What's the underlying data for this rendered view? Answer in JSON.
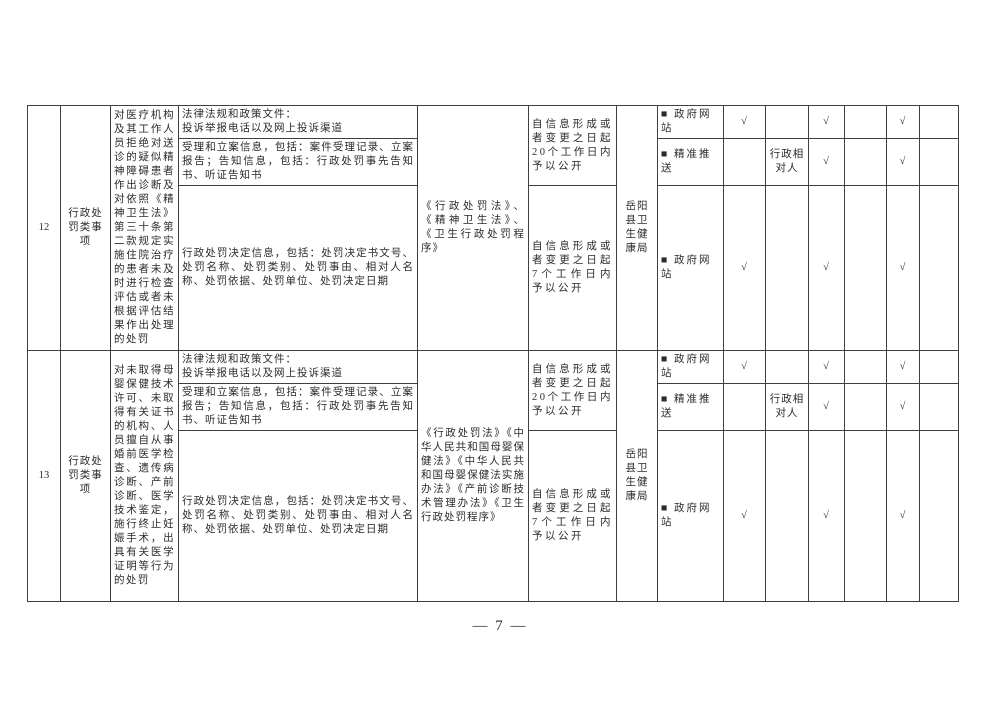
{
  "page": {
    "footer": "— 7 —"
  },
  "table": {
    "rows": [
      {
        "id": "12",
        "category": "行政处罚类事项",
        "description": "对医疗机构及其工作人员拒绝对送诊的疑似精神障碍患者作出诊断及对依照《精神卫生法》第三十条第二款规定实施住院治疗的患者未及时进行检查评估或者未根据评估结果作出处理的处罚",
        "basis": "《行政处罚法》、《精神卫生法》、《卫生行政处罚程序》",
        "timing_first": "自信息形成或者变更之日起20个工作日内予以公开",
        "timing_decision": "自信息形成或者变更之日起7个工作日内予以公开",
        "agency": "岳阳县卫生健康局",
        "subrows": [
          {
            "info": "法律法规和政策文件：\n投诉举报电话以及网上投诉渠道",
            "channel": "■ 政府网站",
            "checks": [
              "√",
              "",
              "√",
              "",
              "√",
              ""
            ]
          },
          {
            "info": "受理和立案信息，包括：案件受理记录、立案报告；告知信息，包括：行政处罚事先告知书、听证告知书",
            "channel": "■ 精准推送",
            "checks": [
              "",
              "行政相对人",
              "√",
              "",
              "√",
              ""
            ]
          },
          {
            "info": "行政处罚决定信息，包括：处罚决定书文号、处罚名称、处罚类别、处罚事由、相对人名称、处罚依据、处罚单位、处罚决定日期",
            "channel": "■ 政府网站",
            "checks": [
              "√",
              "",
              "√",
              "",
              "√",
              ""
            ]
          }
        ]
      },
      {
        "id": "13",
        "category": "行政处罚类事项",
        "description": "对未取得母婴保健技术许可、未取得有关证书的机构、人员擅自从事婚前医学检查、遗传病诊断、产前诊断、医学技术鉴定，施行终止妊娠手术，出具有关医学证明等行为的处罚",
        "basis": "《行政处罚法》《中华人民共和国母婴保健法》《中华人民共和国母婴保健法实施办法》《产前诊断技术管理办法》《卫生行政处罚程序》",
        "timing_first": "自信息形成或者变更之日起20个工作日内予以公开",
        "timing_decision": "自信息形成或者变更之日起7个工作日内予以公开",
        "agency": "岳阳县卫生健康局",
        "subrows": [
          {
            "info": "法律法规和政策文件：\n投诉举报电话以及网上投诉渠道",
            "channel": "■ 政府网站",
            "checks": [
              "√",
              "",
              "√",
              "",
              "√",
              ""
            ]
          },
          {
            "info": "受理和立案信息，包括：案件受理记录、立案报告；告知信息，包括：行政处罚事先告知书、听证告知书",
            "channel": "■ 精准推送",
            "checks": [
              "",
              "行政相对人",
              "√",
              "",
              "√",
              ""
            ]
          },
          {
            "info": "行政处罚决定信息，包括：处罚决定书文号、处罚名称、处罚类别、处罚事由、相对人名称、处罚依据、处罚单位、处罚决定日期",
            "channel": "■ 政府网站",
            "checks": [
              "√",
              "",
              "√",
              "",
              "√",
              ""
            ]
          }
        ]
      }
    ]
  }
}
